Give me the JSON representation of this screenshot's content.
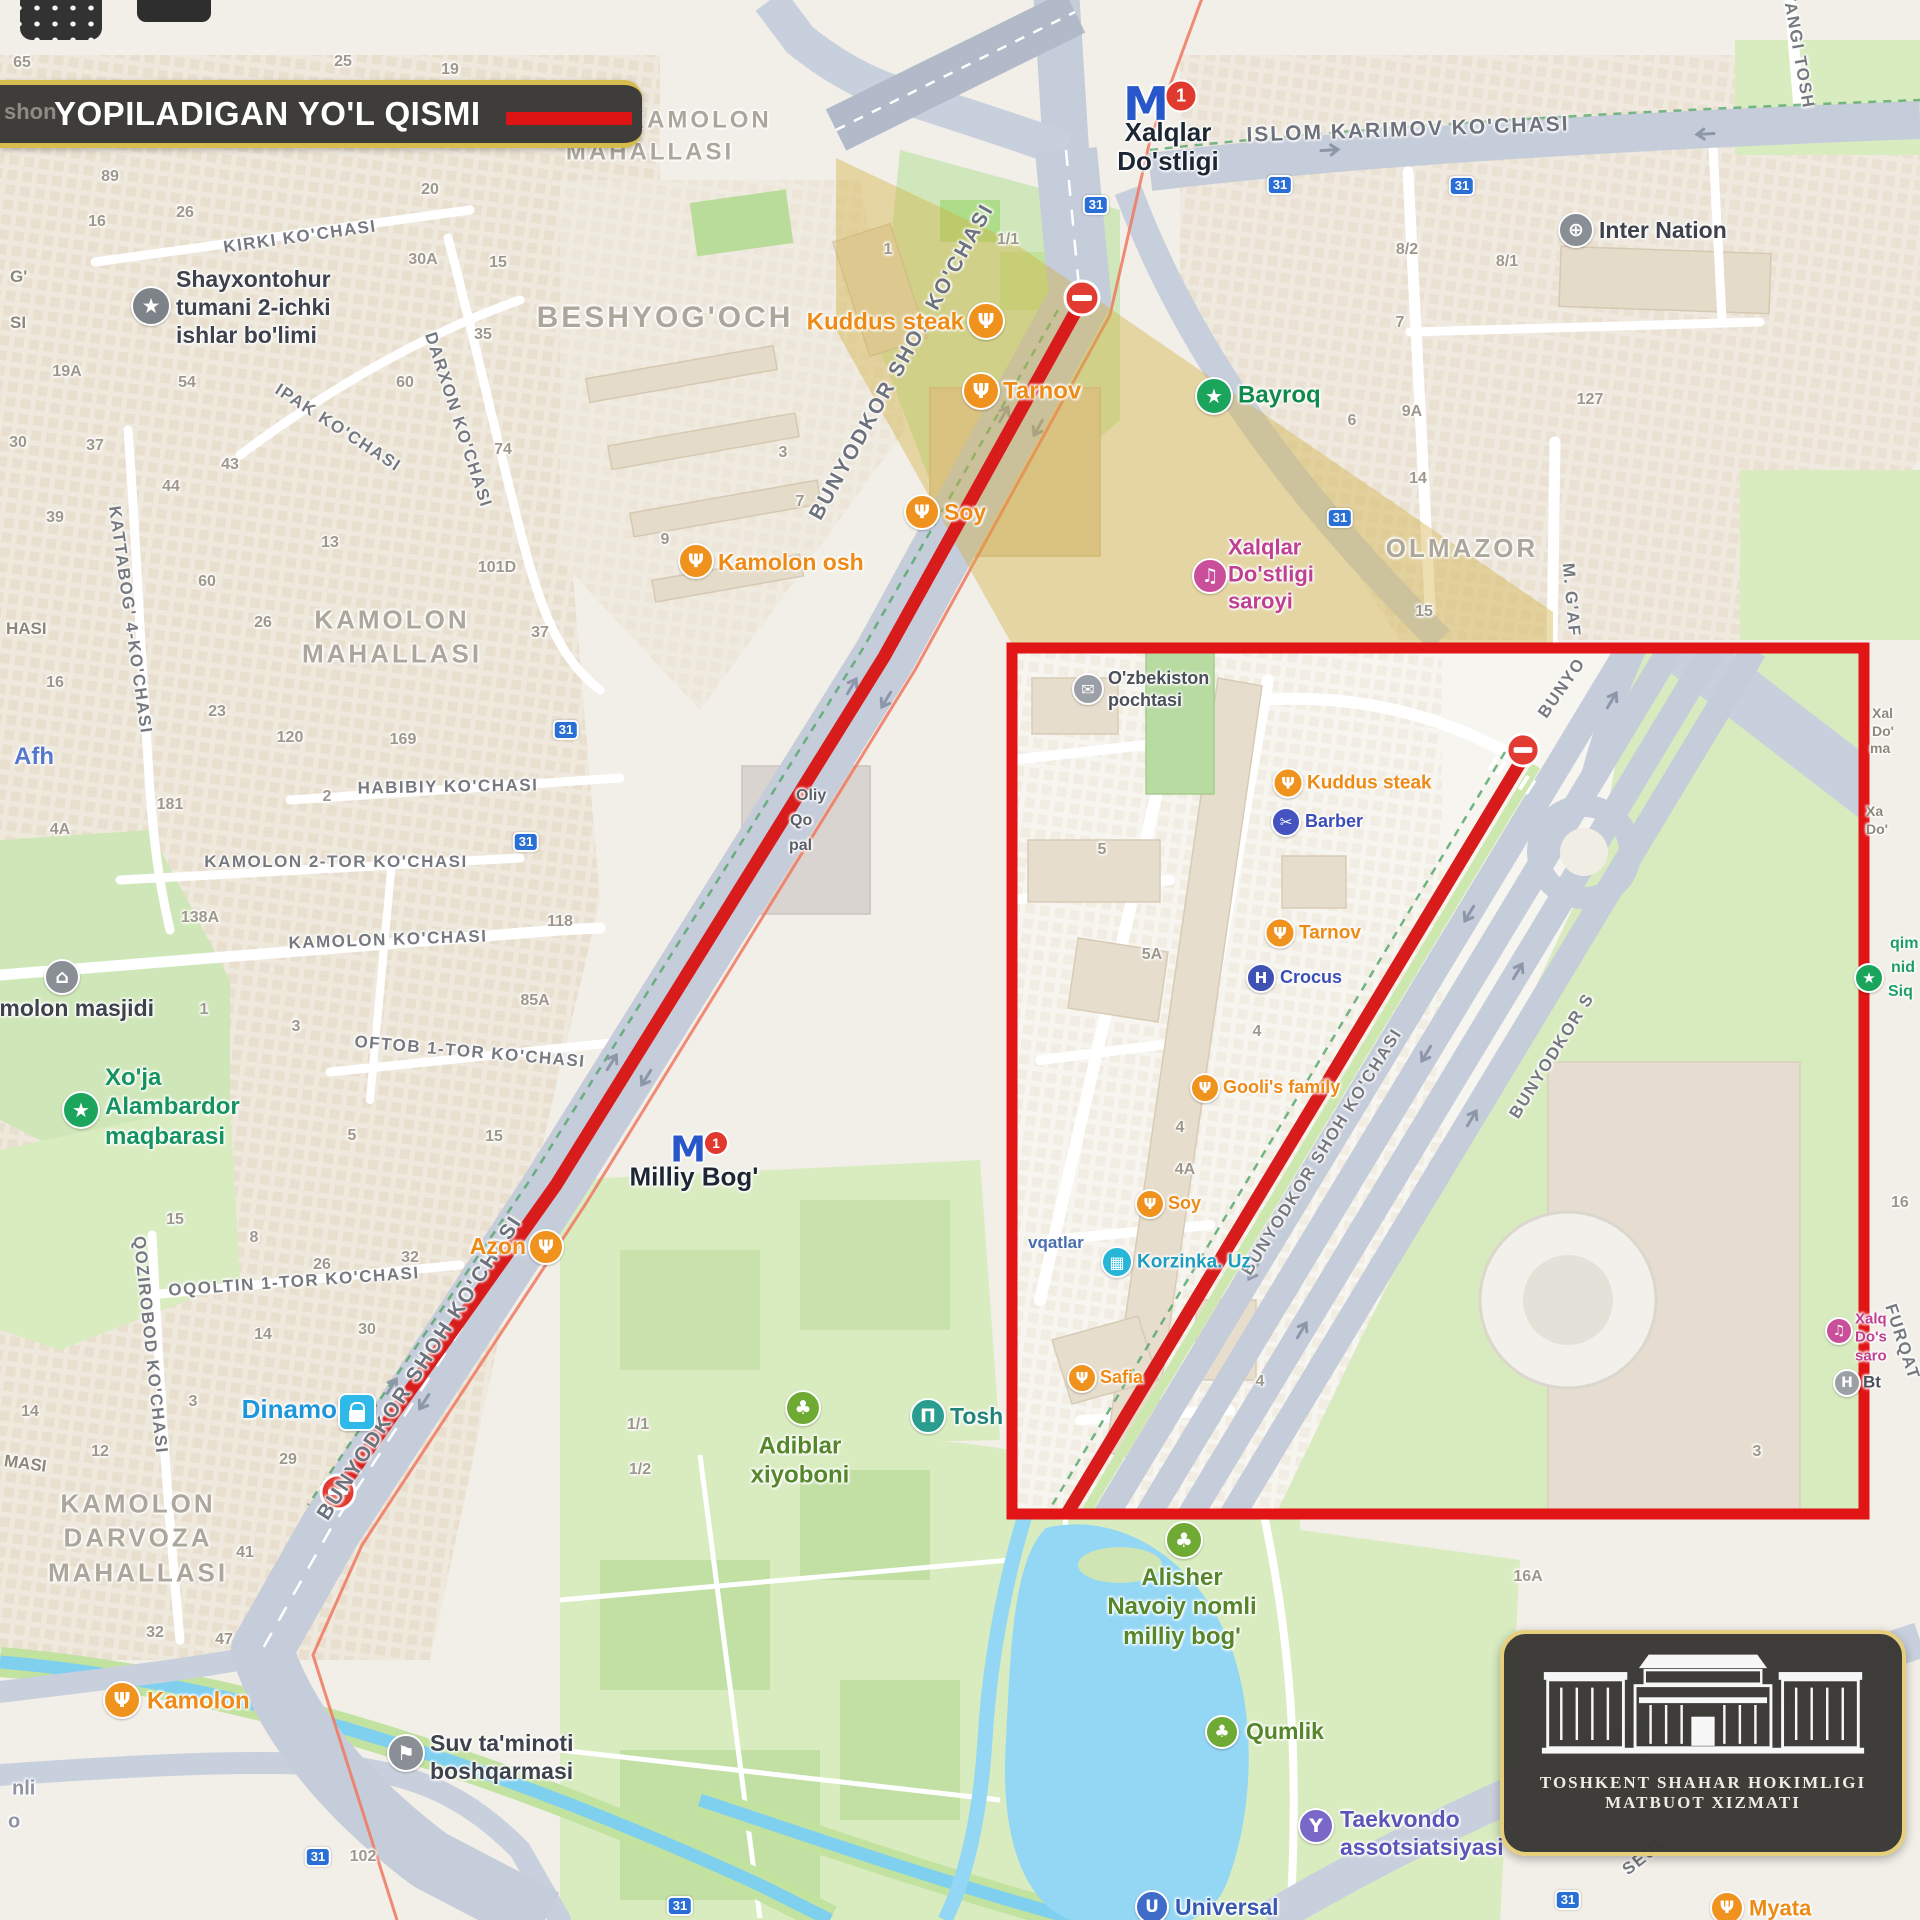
{
  "banner": {
    "title": "YOPILADIGAN YO'L QISMI",
    "legend_color": "#dd1414"
  },
  "logo": {
    "line1": "TOSHKENT SHAHAR HOKIMLIGI",
    "line2": "MATBUOT XIZMATI"
  },
  "badge_text": "31",
  "colors": {
    "closure_red": "#d81b1b",
    "inset_border": "#e11416",
    "banner_gold": "#d7bd4d",
    "road_gray": "#c4cbda",
    "park_green": "#d9ecc0",
    "water_blue": "#93d7f4",
    "highlight_tan": "rgba(210,176,66,0.42)"
  },
  "metro_stations": [
    {
      "n": "xalqlar-dostligi-metro",
      "mx": 1146,
      "my": 104,
      "ms": 46,
      "bx": 1181,
      "by": 96,
      "lines": [
        "Xalqlar",
        "Do'stligi"
      ],
      "tx": 1168,
      "ty": 147,
      "s": 26
    },
    {
      "n": "milliy-bog-metro",
      "mx": 688,
      "my": 1150,
      "ms": 36,
      "bx": 716,
      "by": 1143,
      "lines": [
        "Milliy Bog'"
      ],
      "tx": 694,
      "ty": 1177,
      "s": 26
    }
  ],
  "street_labels": [
    {
      "t": "KIRKI KO'CHASI",
      "x": 300,
      "y": 237,
      "r": -8
    },
    {
      "t": "IPAK KO'CHASI",
      "x": 338,
      "y": 428,
      "r": 33
    },
    {
      "t": "DARXON KO'CHASI",
      "x": 458,
      "y": 420,
      "r": 72
    },
    {
      "t": "KATTABOG' 4-KO'CHASI",
      "x": 130,
      "y": 620,
      "r": 82
    },
    {
      "t": "QOZIROBOD KO'CHASI",
      "x": 150,
      "y": 1345,
      "r": 84
    },
    {
      "t": "HABIBIY KO'CHASI",
      "x": 448,
      "y": 787,
      "r": -1
    },
    {
      "t": "KAMOLON 2-TOR KO'CHASI",
      "x": 336,
      "y": 862,
      "r": 0
    },
    {
      "t": "KAMOLON KO'CHASI",
      "x": 388,
      "y": 940,
      "r": -2
    },
    {
      "t": "OFTOB 1-TOR KO'CHASI",
      "x": 470,
      "y": 1052,
      "r": 5
    },
    {
      "t": "OQOLTIN 1-TOR KO'CHASI",
      "x": 294,
      "y": 1282,
      "r": -4
    },
    {
      "t": "ISLOM KARIMOV KO'CHASI",
      "x": 1408,
      "y": 130,
      "r": -2,
      "big": 1
    },
    {
      "t": "BUNYODKOR SHOH KO'CHASI",
      "x": 902,
      "y": 362,
      "r": -61,
      "big": 1
    },
    {
      "t": "BUNYODKOR SHOH KO'CHASI",
      "x": 420,
      "y": 1368,
      "r": -57,
      "big": 1
    },
    {
      "t": "BUNYODKOR SHOH KO'CHASI",
      "x": 1322,
      "y": 1152,
      "r": -58
    },
    {
      "t": "BUNYODKOR S",
      "x": 1552,
      "y": 1056,
      "r": -58
    },
    {
      "t": "BUNYO",
      "x": 1562,
      "y": 688,
      "r": -55
    },
    {
      "t": "M. G'AF",
      "x": 1571,
      "y": 600,
      "r": 85
    },
    {
      "t": "YANGI TOSH",
      "x": 1798,
      "y": 50,
      "r": 80
    },
    {
      "t": "SEUL",
      "x": 1645,
      "y": 1856,
      "r": -38
    },
    {
      "t": "FURQAT",
      "x": 1902,
      "y": 1342,
      "r": 72
    }
  ],
  "area_labels": [
    {
      "lines": [
        "YANGI KAMOLON",
        "MAHALLASI"
      ],
      "x": 650,
      "y": 136,
      "s": 24
    },
    {
      "lines": [
        "BESHYOG'OCH"
      ],
      "x": 665,
      "y": 318,
      "s": 30
    },
    {
      "lines": [
        "KAMOLON",
        "MAHALLASI"
      ],
      "x": 392,
      "y": 637,
      "s": 26
    },
    {
      "lines": [
        "KAMOLON",
        "DARVOZA",
        "MAHALLASI"
      ],
      "x": 138,
      "y": 1538,
      "s": 26
    },
    {
      "lines": [
        "OLMAZOR"
      ],
      "x": 1462,
      "y": 548,
      "s": 26
    }
  ],
  "pois": [
    {
      "n": "kuddus-steak",
      "icon": "food",
      "ic": "#f0921e",
      "ix": 986,
      "iy": 321,
      "isz": 34,
      "lines": [
        "Kuddus steak"
      ],
      "tc": "#ee8a16",
      "tx": 964,
      "ty": 322,
      "a": "R",
      "s": 24
    },
    {
      "n": "tarnov",
      "icon": "food",
      "ic": "#f0921e",
      "ix": 981,
      "iy": 391,
      "isz": 34,
      "lines": [
        "Tarnov"
      ],
      "tc": "#ee8a16",
      "tx": 1003,
      "ty": 391,
      "a": "L",
      "s": 24
    },
    {
      "n": "soy",
      "icon": "food",
      "ic": "#f0921e",
      "ix": 922,
      "iy": 512,
      "isz": 32,
      "lines": [
        "Soy"
      ],
      "tc": "#ee8a16",
      "tx": 944,
      "ty": 512,
      "a": "L",
      "s": 23
    },
    {
      "n": "kamolon-osh",
      "icon": "food",
      "ic": "#f0921e",
      "ix": 696,
      "iy": 561,
      "isz": 32,
      "lines": [
        "Kamolon osh"
      ],
      "tc": "#ee8a16",
      "tx": 718,
      "ty": 562,
      "a": "L",
      "s": 23
    },
    {
      "n": "azon",
      "icon": "food",
      "ic": "#f0921e",
      "ix": 546,
      "iy": 1247,
      "isz": 32,
      "lines": [
        "Azon"
      ],
      "tc": "#ee8a16",
      "tx": 526,
      "ty": 1246,
      "a": "R",
      "s": 23
    },
    {
      "n": "kamolon-cafe",
      "icon": "food",
      "ic": "#f0921e",
      "ix": 122,
      "iy": 1700,
      "isz": 34,
      "lines": [
        "Kamolon"
      ],
      "tc": "#ee8a16",
      "tx": 147,
      "ty": 1701,
      "a": "L",
      "s": 24
    },
    {
      "n": "myata",
      "icon": "food",
      "ic": "#f0921e",
      "ix": 1727,
      "iy": 1908,
      "isz": 30,
      "lines": [
        "Myata"
      ],
      "tc": "#ee8a16",
      "tx": 1749,
      "ty": 1909,
      "a": "L",
      "s": 22
    },
    {
      "n": "bayroq",
      "icon": "star",
      "ic": "#1ba45c",
      "ix": 1214,
      "iy": 396,
      "isz": 34,
      "lines": [
        "Bayroq"
      ],
      "tc": "#108a4c",
      "tx": 1238,
      "ty": 395,
      "a": "L",
      "s": 24
    },
    {
      "n": "xoja-alambardor-maqbarasi",
      "icon": "star",
      "ic": "#1ba45c",
      "ix": 81,
      "iy": 1110,
      "isz": 34,
      "lines": [
        "Xo'ja",
        "Alambardor",
        "maqbarasi"
      ],
      "tc": "#13935e",
      "tx": 105,
      "ty": 1107,
      "a": "L",
      "s": 24
    },
    {
      "n": "alisher-navoiy-park",
      "icon": "tree",
      "ic": "#6faa34",
      "ix": 1184,
      "iy": 1540,
      "isz": 34,
      "lines": [
        "Alisher",
        "Navoiy nomli",
        "milliy bog'"
      ],
      "tc": "#55862a",
      "tx": 1182,
      "ty": 1607,
      "a": "C",
      "s": 24
    },
    {
      "n": "adiblar-xiyoboni",
      "icon": "tree",
      "ic": "#6faa34",
      "ix": 803,
      "iy": 1408,
      "isz": 32,
      "lines": [
        "Adiblar",
        "xiyoboni"
      ],
      "tc": "#55862a",
      "tx": 800,
      "ty": 1461,
      "a": "C",
      "s": 24
    },
    {
      "n": "qumlik",
      "icon": "tree",
      "ic": "#6faa34",
      "ix": 1222,
      "iy": 1732,
      "isz": 30,
      "lines": [
        "Qumlik"
      ],
      "tc": "#55862a",
      "tx": 1246,
      "ty": 1731,
      "a": "L",
      "s": 23
    },
    {
      "n": "inter-nation",
      "icon": "globe",
      "ic": "#8a8f96",
      "ix": 1576,
      "iy": 230,
      "isz": 32,
      "lines": [
        "Inter Nation"
      ],
      "tc": "#3d424d",
      "tx": 1599,
      "ty": 230,
      "a": "L",
      "s": 23
    },
    {
      "n": "dinamo",
      "icon": "bag",
      "ic": "#2fb9e8",
      "shape": "sq",
      "ix": 357,
      "iy": 1412,
      "isz": 34,
      "lines": [
        "Dinamo"
      ],
      "tc": "#1d96dc",
      "tx": 337,
      "ty": 1410,
      "a": "R",
      "s": 26
    },
    {
      "n": "xalqlar-dostligi-saroyi",
      "icon": "music",
      "ic": "#c94f9b",
      "ix": 1210,
      "iy": 576,
      "isz": 32,
      "lines": [
        "Xalqlar",
        "Do'stligi",
        "saroyi"
      ],
      "tc": "#bf3f90",
      "tx": 1228,
      "ty": 575,
      "a": "L",
      "s": 22
    },
    {
      "n": "tosh-museum",
      "icon": "museum",
      "ic": "#2b9d8f",
      "ix": 928,
      "iy": 1416,
      "isz": 32,
      "lines": [
        "Tosh"
      ],
      "tc": "#22837a",
      "tx": 950,
      "ty": 1416,
      "a": "L",
      "s": 23
    },
    {
      "n": "suv-taminoti-boshqarmasi",
      "icon": "flag",
      "ic": "#8a8f96",
      "ix": 406,
      "iy": 1753,
      "isz": 34,
      "lines": [
        "Suv ta'minoti",
        "boshqarmasi"
      ],
      "tc": "#3d424d",
      "tx": 430,
      "ty": 1757,
      "a": "L",
      "s": 23
    },
    {
      "n": "shayxontohur-ichki-ishlar",
      "icon": "shield",
      "ic": "#7e838a",
      "ix": 151,
      "iy": 306,
      "isz": 36,
      "lines": [
        "Shayxontohur",
        "tumani 2-ichki",
        "ishlar bo'limi"
      ],
      "tc": "#3d424d",
      "tx": 176,
      "ty": 307,
      "a": "L",
      "s": 23
    },
    {
      "n": "kamolon-masjidi",
      "icon": "mosque",
      "ic": "#8a8f96",
      "ix": 62,
      "iy": 977,
      "isz": 32,
      "lines": [
        "Kamolon masjidi"
      ],
      "tc": "#3d424d",
      "tx": 62,
      "ty": 1008,
      "a": "C",
      "s": 23
    },
    {
      "n": "taekvondo-assotsiatsiyasi",
      "icon": "trophy",
      "ic": "#7a68c9",
      "ix": 1316,
      "iy": 1826,
      "isz": 32,
      "lines": [
        "Taekvondo",
        "assotsiatsiyasi"
      ],
      "tc": "#5b55b8",
      "tx": 1340,
      "ty": 1833,
      "a": "L",
      "s": 23
    },
    {
      "n": "universal",
      "icon": "uni",
      "ic": "#3f6bc9",
      "ix": 1152,
      "iy": 1907,
      "isz": 30,
      "lines": [
        "Universal"
      ],
      "tc": "#3758b0",
      "tx": 1175,
      "ty": 1907,
      "a": "L",
      "s": 23
    },
    {
      "n": "ozbekiston-pochtasi",
      "icon": "post",
      "ic": "#9aa0a6",
      "ix": 1088,
      "iy": 689,
      "isz": 28,
      "lines": [
        "O'zbekiston",
        "pochtasi"
      ],
      "tc": "#4a4f58",
      "tx": 1108,
      "ty": 690,
      "a": "L",
      "s": 18
    },
    {
      "n": "barber",
      "icon": "scissors",
      "ic": "#4553c0",
      "ix": 1286,
      "iy": 822,
      "isz": 26,
      "lines": [
        "Barber"
      ],
      "tc": "#3b4db7",
      "tx": 1305,
      "ty": 822,
      "a": "L",
      "s": 18
    },
    {
      "n": "crocus",
      "icon": "H",
      "ic": "#3f51b5",
      "ix": 1261,
      "iy": 978,
      "isz": 26,
      "lines": [
        "Crocus"
      ],
      "tc": "#3b4db7",
      "tx": 1280,
      "ty": 978,
      "a": "L",
      "s": 18
    },
    {
      "n": "kuddus-steak-inset",
      "icon": "food",
      "ic": "#f0921e",
      "ix": 1288,
      "iy": 783,
      "isz": 27,
      "lines": [
        "Kuddus steak"
      ],
      "tc": "#ee8a16",
      "tx": 1307,
      "ty": 783,
      "a": "L",
      "s": 19
    },
    {
      "n": "tarnov-inset",
      "icon": "food",
      "ic": "#f0921e",
      "ix": 1280,
      "iy": 933,
      "isz": 27,
      "lines": [
        "Tarnov"
      ],
      "tc": "#ee8a16",
      "tx": 1299,
      "ty": 933,
      "a": "L",
      "s": 19
    },
    {
      "n": "goolis-family",
      "icon": "food",
      "ic": "#f0921e",
      "ix": 1205,
      "iy": 1088,
      "isz": 26,
      "lines": [
        "Gooli's family"
      ],
      "tc": "#ee8a16",
      "tx": 1223,
      "ty": 1088,
      "a": "L",
      "s": 18
    },
    {
      "n": "soy-inset",
      "icon": "food",
      "ic": "#f0921e",
      "ix": 1150,
      "iy": 1204,
      "isz": 26,
      "lines": [
        "Soy"
      ],
      "tc": "#ee8a16",
      "tx": 1168,
      "ty": 1204,
      "a": "L",
      "s": 18
    },
    {
      "n": "korzinka-uz",
      "icon": "cart",
      "ic": "#27b6d8",
      "ix": 1117,
      "iy": 1262,
      "isz": 28,
      "lines": [
        "Korzinka. Uz"
      ],
      "tc": "#1f9dc0",
      "tx": 1137,
      "ty": 1262,
      "a": "L",
      "s": 19
    },
    {
      "n": "safia",
      "icon": "food",
      "ic": "#f0921e",
      "ix": 1082,
      "iy": 1378,
      "isz": 26,
      "lines": [
        "Safia"
      ],
      "tc": "#ee8a16",
      "tx": 1100,
      "ty": 1378,
      "a": "L",
      "s": 18
    },
    {
      "n": "bt",
      "icon": "H",
      "ic": "#9aa0a6",
      "ix": 1847,
      "iy": 1383,
      "isz": 24,
      "lines": [
        "Bt"
      ],
      "tc": "#4a4f58",
      "tx": 1863,
      "ty": 1383,
      "a": "L",
      "s": 17
    },
    {
      "n": "xalqlar-saroyi-inset",
      "icon": "music",
      "ic": "#c94f9b",
      "ix": 1839,
      "iy": 1331,
      "isz": 24,
      "lines": [
        "Xalq",
        "Do's",
        "saro"
      ],
      "tc": "#bf3f90",
      "tx": 1855,
      "ty": 1338,
      "a": "L",
      "s": 15
    },
    {
      "n": "green-star-right",
      "icon": "star",
      "ic": "#1ba45c",
      "ix": 1869,
      "iy": 978,
      "isz": 26,
      "lines": [],
      "tc": "#13935e",
      "tx": 0,
      "ty": 0,
      "a": "L",
      "s": 15
    }
  ],
  "house_numbers": [
    {
      "t": "65",
      "x": 22,
      "y": 63
    },
    {
      "t": "25",
      "x": 343,
      "y": 62
    },
    {
      "t": "19",
      "x": 450,
      "y": 70
    },
    {
      "t": "89",
      "x": 110,
      "y": 177
    },
    {
      "t": "16",
      "x": 97,
      "y": 222
    },
    {
      "t": "26",
      "x": 185,
      "y": 213
    },
    {
      "t": "30A",
      "x": 423,
      "y": 260
    },
    {
      "t": "15",
      "x": 498,
      "y": 263
    },
    {
      "t": "20",
      "x": 430,
      "y": 190
    },
    {
      "t": "19A",
      "x": 67,
      "y": 372
    },
    {
      "t": "54",
      "x": 187,
      "y": 383
    },
    {
      "t": "35",
      "x": 483,
      "y": 335
    },
    {
      "t": "60",
      "x": 405,
      "y": 383
    },
    {
      "t": "43",
      "x": 230,
      "y": 465
    },
    {
      "t": "44",
      "x": 171,
      "y": 487
    },
    {
      "t": "30",
      "x": 18,
      "y": 443
    },
    {
      "t": "37",
      "x": 95,
      "y": 446
    },
    {
      "t": "39",
      "x": 55,
      "y": 518
    },
    {
      "t": "74",
      "x": 503,
      "y": 450
    },
    {
      "t": "13",
      "x": 330,
      "y": 543
    },
    {
      "t": "60",
      "x": 207,
      "y": 582
    },
    {
      "t": "26",
      "x": 263,
      "y": 623
    },
    {
      "t": "101D",
      "x": 497,
      "y": 568
    },
    {
      "t": "37",
      "x": 540,
      "y": 633
    },
    {
      "t": "23",
      "x": 217,
      "y": 712
    },
    {
      "t": "120",
      "x": 290,
      "y": 738
    },
    {
      "t": "169",
      "x": 403,
      "y": 740
    },
    {
      "t": "16",
      "x": 55,
      "y": 683
    },
    {
      "t": "181",
      "x": 170,
      "y": 805
    },
    {
      "t": "2",
      "x": 327,
      "y": 797
    },
    {
      "t": "4A",
      "x": 60,
      "y": 830
    },
    {
      "t": "138A",
      "x": 200,
      "y": 918
    },
    {
      "t": "118",
      "x": 560,
      "y": 922
    },
    {
      "t": "85A",
      "x": 535,
      "y": 1001
    },
    {
      "t": "1",
      "x": 204,
      "y": 1010
    },
    {
      "t": "3",
      "x": 296,
      "y": 1027
    },
    {
      "t": "5",
      "x": 352,
      "y": 1136
    },
    {
      "t": "15",
      "x": 494,
      "y": 1137
    },
    {
      "t": "15",
      "x": 175,
      "y": 1220
    },
    {
      "t": "8",
      "x": 254,
      "y": 1238
    },
    {
      "t": "26",
      "x": 322,
      "y": 1265
    },
    {
      "t": "32",
      "x": 410,
      "y": 1258
    },
    {
      "t": "30",
      "x": 367,
      "y": 1330
    },
    {
      "t": "14",
      "x": 263,
      "y": 1335
    },
    {
      "t": "3",
      "x": 193,
      "y": 1402
    },
    {
      "t": "14",
      "x": 30,
      "y": 1412
    },
    {
      "t": "12",
      "x": 100,
      "y": 1452
    },
    {
      "t": "29",
      "x": 288,
      "y": 1460
    },
    {
      "t": "41",
      "x": 245,
      "y": 1553
    },
    {
      "t": "32",
      "x": 155,
      "y": 1633
    },
    {
      "t": "47",
      "x": 224,
      "y": 1640
    },
    {
      "t": "102",
      "x": 363,
      "y": 1857
    },
    {
      "t": "1",
      "x": 888,
      "y": 250
    },
    {
      "t": "1/1",
      "x": 1008,
      "y": 240
    },
    {
      "t": "3",
      "x": 783,
      "y": 453
    },
    {
      "t": "7",
      "x": 800,
      "y": 502
    },
    {
      "t": "9",
      "x": 665,
      "y": 540
    },
    {
      "t": "1/1",
      "x": 638,
      "y": 1425
    },
    {
      "t": "1/2",
      "x": 640,
      "y": 1470
    },
    {
      "t": "8/2",
      "x": 1407,
      "y": 250
    },
    {
      "t": "8/1",
      "x": 1507,
      "y": 262
    },
    {
      "t": "7",
      "x": 1400,
      "y": 323
    },
    {
      "t": "6",
      "x": 1352,
      "y": 421
    },
    {
      "t": "9A",
      "x": 1412,
      "y": 412
    },
    {
      "t": "127",
      "x": 1590,
      "y": 400
    },
    {
      "t": "14",
      "x": 1418,
      "y": 479
    },
    {
      "t": "15",
      "x": 1424,
      "y": 612
    },
    {
      "t": "16A",
      "x": 1528,
      "y": 1577
    },
    {
      "t": "5",
      "x": 1102,
      "y": 850
    },
    {
      "t": "5A",
      "x": 1152,
      "y": 955
    },
    {
      "t": "4",
      "x": 1257,
      "y": 1032
    },
    {
      "t": "4",
      "x": 1180,
      "y": 1128
    },
    {
      "t": "4A",
      "x": 1185,
      "y": 1170
    },
    {
      "t": "4",
      "x": 1260,
      "y": 1382
    },
    {
      "t": "3",
      "x": 1757,
      "y": 1452
    }
  ],
  "road_badges": [
    {
      "x": 1096,
      "y": 205
    },
    {
      "x": 1280,
      "y": 185
    },
    {
      "x": 1462,
      "y": 186
    },
    {
      "x": 1340,
      "y": 518
    },
    {
      "x": 566,
      "y": 730
    },
    {
      "x": 526,
      "y": 842
    },
    {
      "x": 318,
      "y": 1857
    },
    {
      "x": 680,
      "y": 1906
    },
    {
      "x": 1568,
      "y": 1900
    }
  ],
  "fragments": [
    {
      "t": "shon",
      "x": 26,
      "y": 119,
      "c": "#b9b4ac",
      "s": 22
    },
    {
      "t": "G'",
      "x": 10,
      "y": 277
    },
    {
      "t": "SI",
      "x": 10,
      "y": 323
    },
    {
      "t": "HASI",
      "x": 6,
      "y": 629
    },
    {
      "t": "MASI",
      "x": 4,
      "y": 1464,
      "r": 8
    },
    {
      "t": "Afh",
      "x": 14,
      "y": 757,
      "c": "#5577cc",
      "s": 24
    },
    {
      "t": "nli",
      "x": 12,
      "y": 1789,
      "c": "#8f93a3",
      "s": 20
    },
    {
      "t": "o",
      "x": 8,
      "y": 1822,
      "c": "#8f93a3",
      "s": 20
    },
    {
      "t": "Xal",
      "x": 1872,
      "y": 713,
      "s": 14
    },
    {
      "t": "Do'",
      "x": 1872,
      "y": 731,
      "s": 14
    },
    {
      "t": "ma",
      "x": 1870,
      "y": 748,
      "s": 14
    },
    {
      "t": "Xa",
      "x": 1866,
      "y": 811,
      "s": 14
    },
    {
      "t": "Do'",
      "x": 1866,
      "y": 829,
      "s": 14
    },
    {
      "t": "qim",
      "x": 1890,
      "y": 944,
      "c": "#1f9e63",
      "s": 16
    },
    {
      "t": "nid",
      "x": 1891,
      "y": 968,
      "c": "#1f9e63",
      "s": 16
    },
    {
      "t": "Siq",
      "x": 1888,
      "y": 992,
      "c": "#1f9e63",
      "s": 16
    },
    {
      "t": "vqatlar",
      "x": 1028,
      "y": 1243,
      "c": "#4a6fae",
      "s": 17
    },
    {
      "t": "Oliy",
      "x": 796,
      "y": 796,
      "c": "#5a5f66",
      "s": 16
    },
    {
      "t": "Qo",
      "x": 790,
      "y": 821,
      "c": "#5a5f66",
      "s": 16
    },
    {
      "t": "pal",
      "x": 789,
      "y": 846,
      "c": "#5a5f66",
      "s": 16
    },
    {
      "t": "16",
      "x": 1891,
      "y": 1203,
      "c": "#9e978b",
      "s": 16
    }
  ]
}
